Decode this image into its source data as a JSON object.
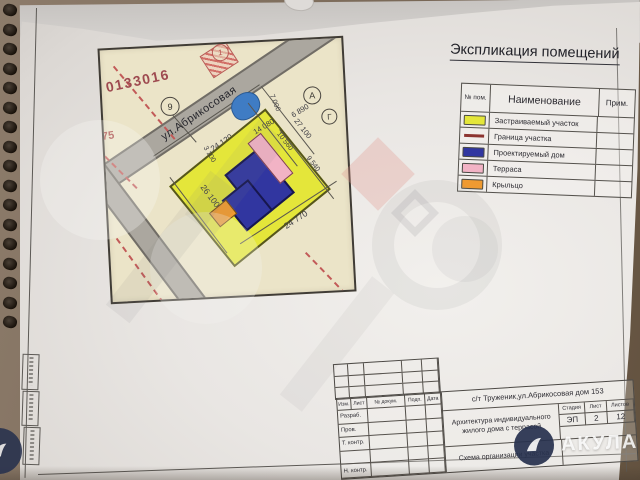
{
  "legend": {
    "title": "Экспликация помещений",
    "col_num": "№ пом.",
    "col_name": "Наименование",
    "col_note": "Прим.",
    "rows": [
      {
        "name": "Застраиваемый  участок",
        "color": "#e4e63a",
        "swatch": "fill"
      },
      {
        "name": "Граница участка",
        "color": "#8c3430",
        "swatch": "line"
      },
      {
        "name": "Проектируемый дом",
        "color": "#3136a0",
        "swatch": "fill"
      },
      {
        "name": "Терраса",
        "color": "#f2b3c5",
        "swatch": "fill"
      },
      {
        "name": "Крыльцо",
        "color": "#ef9a31",
        "swatch": "fill"
      }
    ]
  },
  "map": {
    "cadastral_number": "0133016",
    "parcel_number_left": "75",
    "street": "ул.Абрикосовая",
    "marker_1": "1",
    "marker_9": "9",
    "marker_a": "А",
    "marker_g": "Г",
    "dims": {
      "road": "24 120",
      "top1": "14 080",
      "top2": "6 890",
      "left_small": "3 100",
      "left": "26 100",
      "bottom": "24 770",
      "r1": "7 000",
      "r2": "27 100",
      "r3": "10 560",
      "r4": "9 540"
    }
  },
  "stamp": {
    "address": "с/т Труженик,ул.Абрикосовая дом 153",
    "cols": [
      "Изм.",
      "Лист",
      "№ докум.",
      "Подп.",
      "Дата"
    ],
    "row_labels": [
      "Разраб.",
      "Пров.",
      "Т. контр.",
      "",
      "Н. контр."
    ],
    "project": "Архитектура индивидуального жилого дома с террасой",
    "stage_label": "Стадия",
    "sheet_label": "Лист",
    "sheets_label": "Листов",
    "stage": "ЭП",
    "sheet": "2",
    "sheets": "12",
    "drawing": "Схема организации участка"
  },
  "watermark": {
    "brand": "АКУЛА"
  }
}
